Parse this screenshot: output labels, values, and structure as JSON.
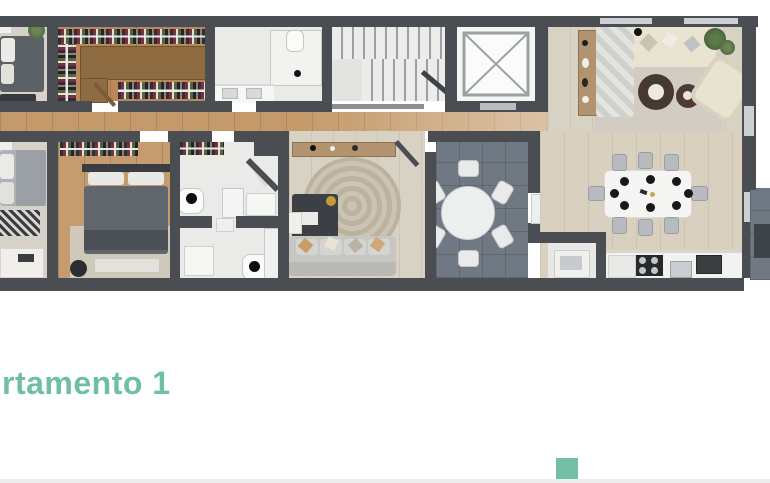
{
  "title": {
    "text": "rtamento 1",
    "color": "#6fbfa5"
  },
  "accent_square": {
    "color": "#72bfa3"
  },
  "palette": {
    "wall": "#4a4e53",
    "wood_floor": "#b9895a",
    "light_plank_floor": "#d8d2c5",
    "marble_floor": "#eaeae8",
    "terrace_tile": "#6f7883",
    "sofa_cream": "#e9e3d2",
    "bed_dark": "#5c6166",
    "accent_teal": "#6fbfa5",
    "footer_divider": "#ededed"
  }
}
